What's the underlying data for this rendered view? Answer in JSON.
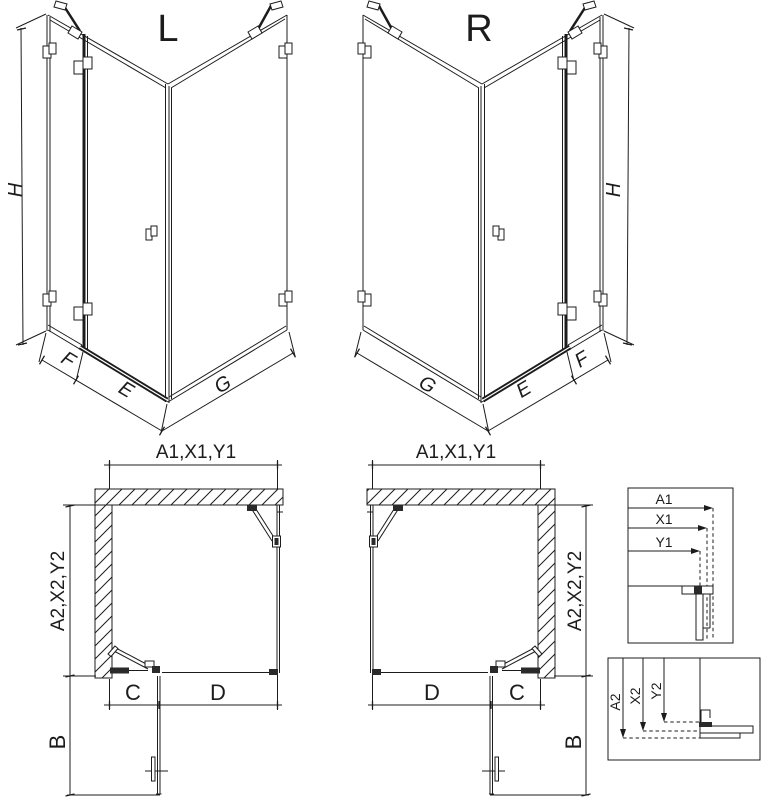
{
  "colors": {
    "line": "#1c1c1c",
    "background": "#ffffff"
  },
  "isometric": {
    "left_label": "L",
    "right_label": "R",
    "dims": {
      "height": "H",
      "wall_panel": "F",
      "door": "E",
      "side_panel": "G"
    }
  },
  "plan": {
    "width_chain": "A1,X1,Y1",
    "depth_chain": "A2,X2,Y2",
    "fixed_width": "C",
    "door_width": "D",
    "open_door_depth": "B"
  },
  "details": {
    "width": {
      "a1": "A1",
      "x1": "X1",
      "y1": "Y1"
    },
    "depth": {
      "a2": "A2",
      "x2": "X2",
      "y2": "Y2"
    }
  }
}
